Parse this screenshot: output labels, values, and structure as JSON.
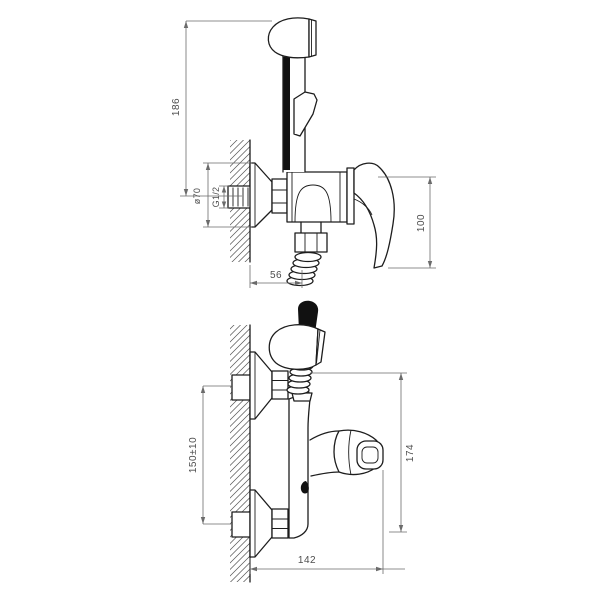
{
  "drawing": {
    "side_view": {
      "dims": {
        "overall_height": "186",
        "flange_diameter": "ø70",
        "thread_size": "G1/2",
        "lever_height": "100",
        "hose_offset": "56"
      }
    },
    "front_view": {
      "dims": {
        "mounting_height": "150±10",
        "body_height": "174",
        "overall_depth": "142"
      }
    }
  },
  "colors": {
    "outline": "#1d1d1d",
    "dimension_line": "#6b6b6b",
    "dimension_text": "#4d4d4d",
    "hatch": "#555555",
    "solid_fill": "#111111",
    "background": "#ffffff"
  }
}
